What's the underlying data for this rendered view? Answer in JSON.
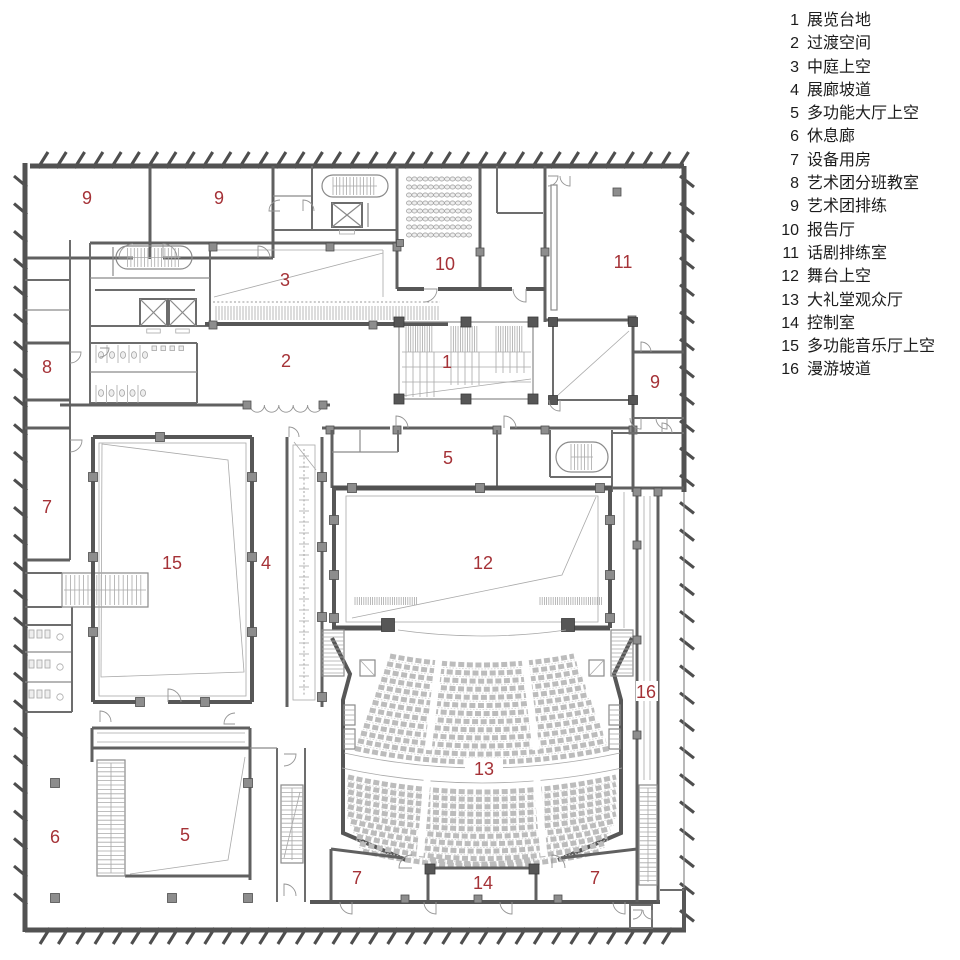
{
  "colors": {
    "label_red": "#a53237",
    "legend_text": "#1c1c1c",
    "wall_gray": "#575757",
    "seat_gray": "#bcbcbc",
    "background": "#ffffff"
  },
  "legend": {
    "items": [
      {
        "num": "1",
        "label": "展览台地"
      },
      {
        "num": "2",
        "label": "过渡空间"
      },
      {
        "num": "3",
        "label": "中庭上空"
      },
      {
        "num": "4",
        "label": "展廊坡道"
      },
      {
        "num": "5",
        "label": "多功能大厅上空"
      },
      {
        "num": "6",
        "label": "休息廊"
      },
      {
        "num": "7",
        "label": "设备用房"
      },
      {
        "num": "8",
        "label": "艺术团分班教室"
      },
      {
        "num": "9",
        "label": "艺术团排练"
      },
      {
        "num": "10",
        "label": "报告厅"
      },
      {
        "num": "11",
        "label": "话剧排练室"
      },
      {
        "num": "12",
        "label": "舞台上空"
      },
      {
        "num": "13",
        "label": "大礼堂观众厅"
      },
      {
        "num": "14",
        "label": "控制室"
      },
      {
        "num": "15",
        "label": "多功能音乐厅上空"
      },
      {
        "num": "16",
        "label": "漫游坡道"
      }
    ]
  },
  "plan": {
    "room_labels": [
      {
        "num": "9",
        "x": 87,
        "y": 198
      },
      {
        "num": "9",
        "x": 219,
        "y": 198
      },
      {
        "num": "10",
        "x": 445,
        "y": 264
      },
      {
        "num": "11",
        "x": 623,
        "y": 262
      },
      {
        "num": "3",
        "x": 285,
        "y": 280
      },
      {
        "num": "2",
        "x": 286,
        "y": 361
      },
      {
        "num": "1",
        "x": 447,
        "y": 362
      },
      {
        "num": "8",
        "x": 47,
        "y": 367
      },
      {
        "num": "9",
        "x": 655,
        "y": 382
      },
      {
        "num": "5",
        "x": 448,
        "y": 458
      },
      {
        "num": "7",
        "x": 47,
        "y": 507
      },
      {
        "num": "15",
        "x": 172,
        "y": 563
      },
      {
        "num": "4",
        "x": 266,
        "y": 563
      },
      {
        "num": "12",
        "x": 483,
        "y": 563
      },
      {
        "num": "16",
        "x": 646,
        "y": 692
      },
      {
        "num": "13",
        "x": 484,
        "y": 769
      },
      {
        "num": "6",
        "x": 55,
        "y": 837
      },
      {
        "num": "5",
        "x": 185,
        "y": 835
      },
      {
        "num": "7",
        "x": 357,
        "y": 878
      },
      {
        "num": "14",
        "x": 483,
        "y": 883
      },
      {
        "num": "7",
        "x": 595,
        "y": 878
      }
    ]
  }
}
